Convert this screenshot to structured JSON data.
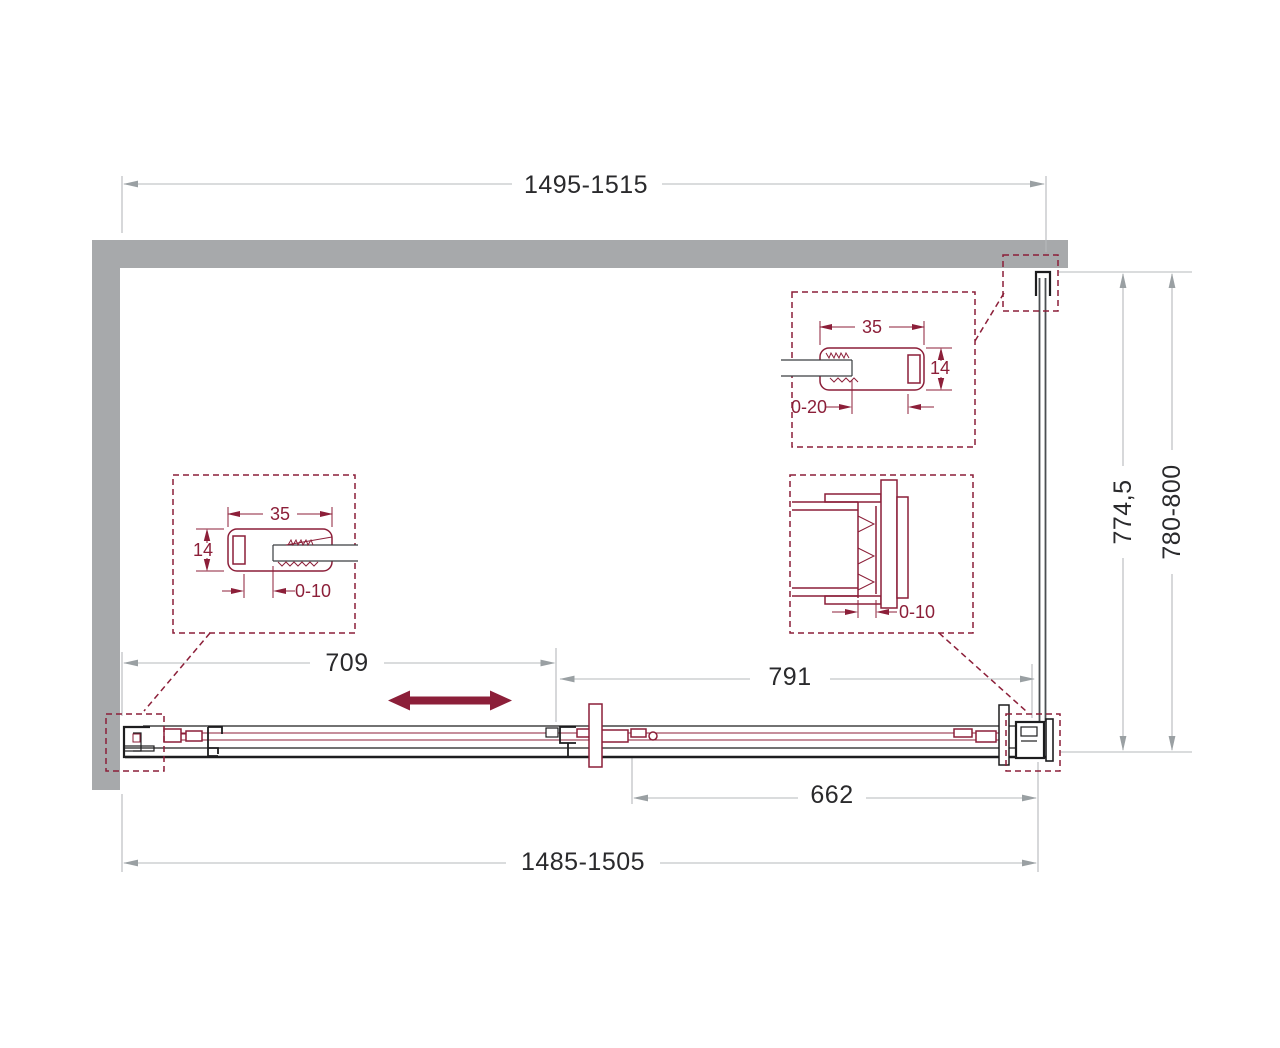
{
  "colors": {
    "wall": "#a7a9ab",
    "accent": "#8c1f39",
    "dim": "#b6b9bb",
    "dimarrow": "#9aa0a3",
    "ink": "#2a2a2c",
    "line": "#1d1d1f"
  },
  "dims": {
    "top_width": "1495-1515",
    "depth_inner": "774,5",
    "depth_outer": "780-800",
    "left_width": "709",
    "right_width": "791",
    "opening_width": "662",
    "bottom_width": "1485-1505"
  },
  "detail_left": {
    "width": "35",
    "thickness": "14",
    "adjust": "0-10"
  },
  "detail_top": {
    "width": "35",
    "thickness": "14",
    "adjust": "0-20"
  },
  "detail_corner": {
    "adjust": "0-10"
  }
}
